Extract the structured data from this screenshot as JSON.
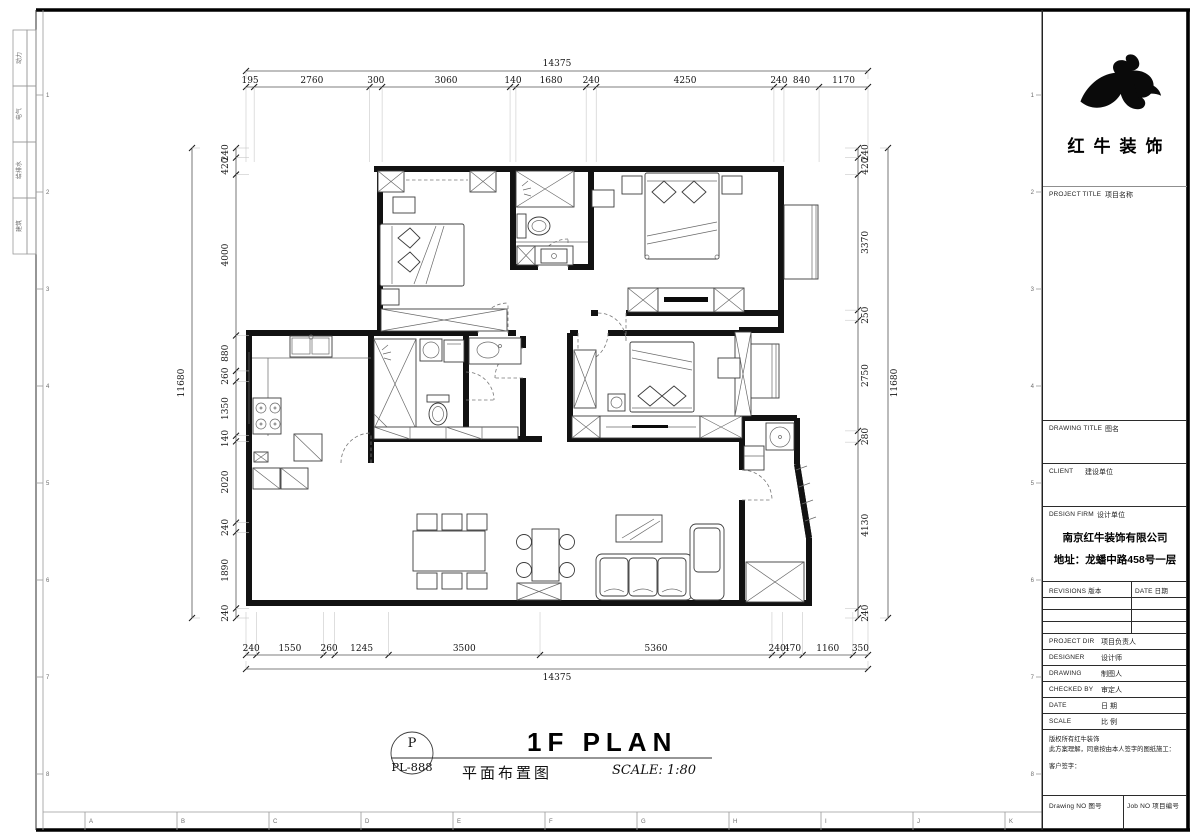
{
  "frame": {
    "signoff_labels": [
      "动力",
      "电气",
      "给排水",
      "建筑"
    ],
    "bottom_letters": [
      "A",
      "B",
      "C",
      "D",
      "E",
      "F",
      "G",
      "H",
      "I",
      "J",
      "K"
    ],
    "side_numbers": [
      "1",
      "2",
      "3",
      "4",
      "5",
      "6",
      "7",
      "8"
    ]
  },
  "dimensions": {
    "top": {
      "total": "14375",
      "segments": [
        195,
        2760,
        300,
        3060,
        140,
        1680,
        240,
        4250,
        240,
        840,
        1170
      ]
    },
    "bottom": {
      "total": "14375",
      "segments": [
        240,
        1550,
        260,
        1245,
        3500,
        5360,
        240,
        470,
        1160,
        350
      ]
    },
    "left": {
      "total": "11680",
      "segments": [
        240,
        420,
        4000,
        880,
        260,
        1350,
        140,
        2020,
        240,
        1890,
        240
      ]
    },
    "right": {
      "total": "11680",
      "segments": [
        240,
        420,
        3370,
        250,
        2750,
        280,
        4130,
        240
      ]
    }
  },
  "drawing_title": {
    "tag_top": "P",
    "tag_bottom": "PL-888",
    "title_en": "1F PLAN",
    "title_cn": "平面布置图",
    "scale": "SCALE: 1:80"
  },
  "title_block": {
    "brand": "红牛装饰",
    "project_label_en": "PROJECT TITLE",
    "project_label_cn": "项目名称",
    "drawing_label_en": "DRAWING TITLE",
    "drawing_label_cn": "图名",
    "client_label_en": "CLIENT",
    "client_label_cn": "建设单位",
    "design_firm_label_en": "DESIGN FIRM",
    "design_firm_label_cn": "设计单位",
    "company": "南京红牛装饰有限公司",
    "address": "地址：龙蟠中路458号一层",
    "revisions_label": "REVISIONS 版本",
    "date_col_label": "DATE 日期",
    "rows": [
      {
        "en": "PROJECT DIR",
        "cn": "项目负责人"
      },
      {
        "en": "DESIGNER",
        "cn": "设计师"
      },
      {
        "en": "DRAWING",
        "cn": "制图人"
      },
      {
        "en": "CHECKED BY",
        "cn": "审定人"
      },
      {
        "en": "DATE",
        "cn": "日  期"
      },
      {
        "en": "SCALE",
        "cn": "比  例"
      }
    ],
    "copyright_lines": [
      "版权所有红牛装饰",
      "此方案理解，同意按由本人签字的图纸施工：",
      "客户签字："
    ],
    "drawing_no_label": "Drawing NO 图号",
    "job_no_label": "Job NO 项目编号"
  }
}
